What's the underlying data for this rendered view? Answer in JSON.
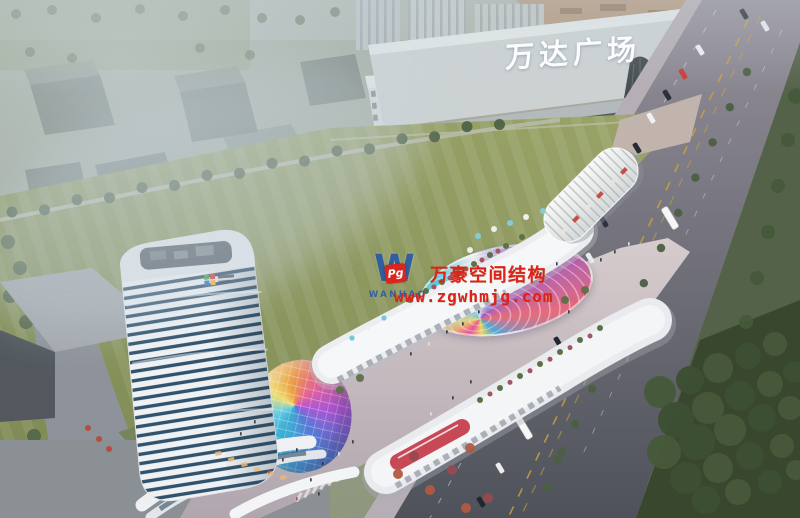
{
  "scene": {
    "description": "Aerial architectural rendering of a mixed-use commercial plaza (tower, retail strips, rainbow membrane canopy) beside an existing Wanda Plaza mall, with roads, traffic and a large lawn",
    "width_px": 800,
    "height_px": 518
  },
  "signs": {
    "mall_roof_sign": "万达广场"
  },
  "watermark": {
    "logo_letter": "W",
    "logo_badge": "Pg",
    "logo_name": "WANHAO",
    "title": "万豪空间结构",
    "url": "www.zgwhmjg.com",
    "text_color": "#e0201a",
    "logo_blue": "#2456a8",
    "badge_red": "#d8261f"
  },
  "palette": {
    "lawn_green": "#8e9a5e",
    "haze_blue": "#c3ced8",
    "road_gray": "#84828e",
    "road_dark": "#50545c",
    "tree_green": "#4f6347",
    "tree_dark": "#3c4f33",
    "tower_glass": "#32526b",
    "roof_white": "#eceef0",
    "mall_gray": "#ccd2d2",
    "accent_red": "#c23a46",
    "canopy_pink": "#e8509a",
    "canopy_cyan": "#58c8e4",
    "canopy_yellow": "#f0e05a"
  }
}
